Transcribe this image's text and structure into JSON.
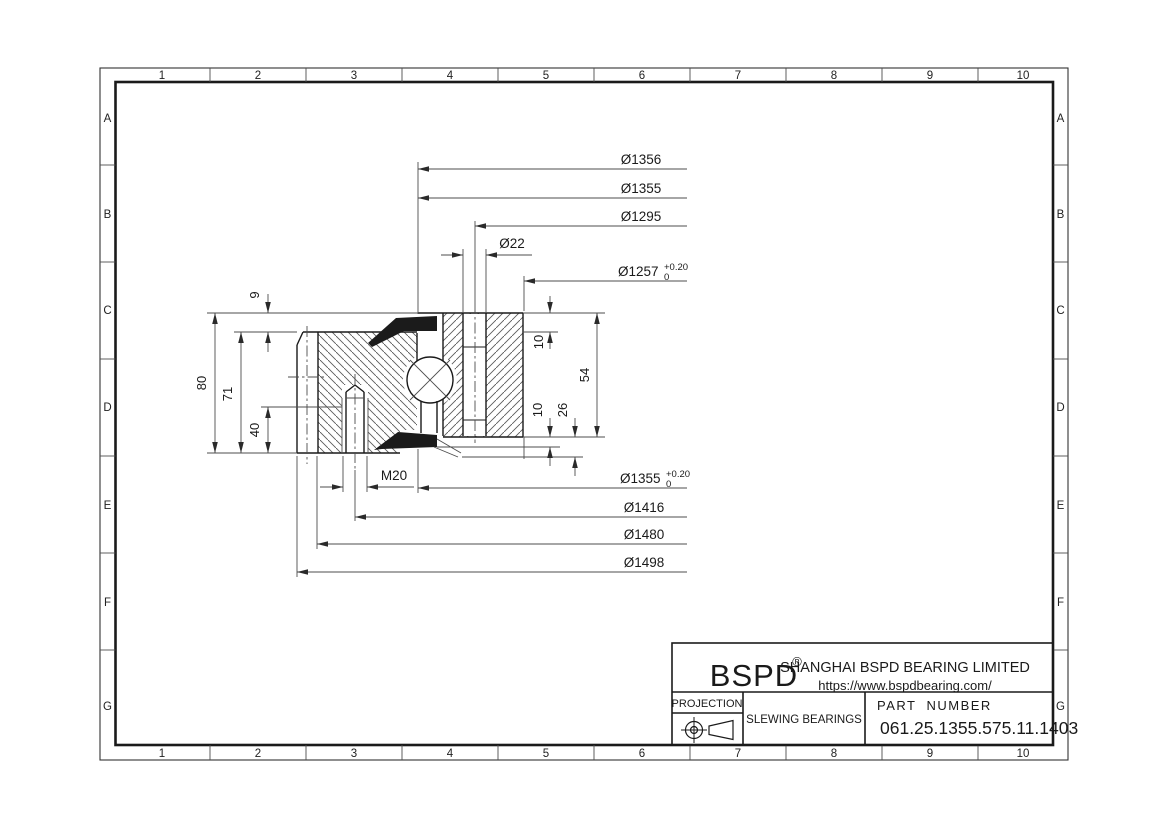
{
  "grid": {
    "columns": [
      "1",
      "2",
      "3",
      "4",
      "5",
      "6",
      "7",
      "8",
      "9",
      "10"
    ],
    "rows": [
      "A",
      "B",
      "C",
      "D",
      "E",
      "F",
      "G"
    ]
  },
  "dims": {
    "d1356": "Ø1356",
    "d1355": "Ø1355",
    "d1295": "Ø1295",
    "d1257_main": "Ø1257",
    "d1257_tol_up": "+0.20",
    "d1257_tol_dn": "0",
    "d22": "Ø22",
    "d1355b_main": "Ø1355",
    "d1355b_tol_up": "+0.20",
    "d1355b_tol_dn": "0",
    "d1416": "Ø1416",
    "d1480": "Ø1480",
    "d1498": "Ø1498",
    "m20": "M20",
    "h9": "9",
    "h80": "80",
    "h71": "71",
    "h40": "40",
    "r10_top": "10",
    "r54": "54",
    "r10_bottom": "10",
    "r26": "26"
  },
  "title_block": {
    "logo": "BSPD",
    "registered": "®",
    "company": "SHANGHAI BSPD BEARING LIMITED",
    "website": "https://www.bspdbearing.com/",
    "projection_label": "PROJECTION",
    "product_type": "SLEWING BEARINGS",
    "part_number_label": "PART  NUMBER",
    "part_number": "061.25.1355.575.11.1403"
  }
}
